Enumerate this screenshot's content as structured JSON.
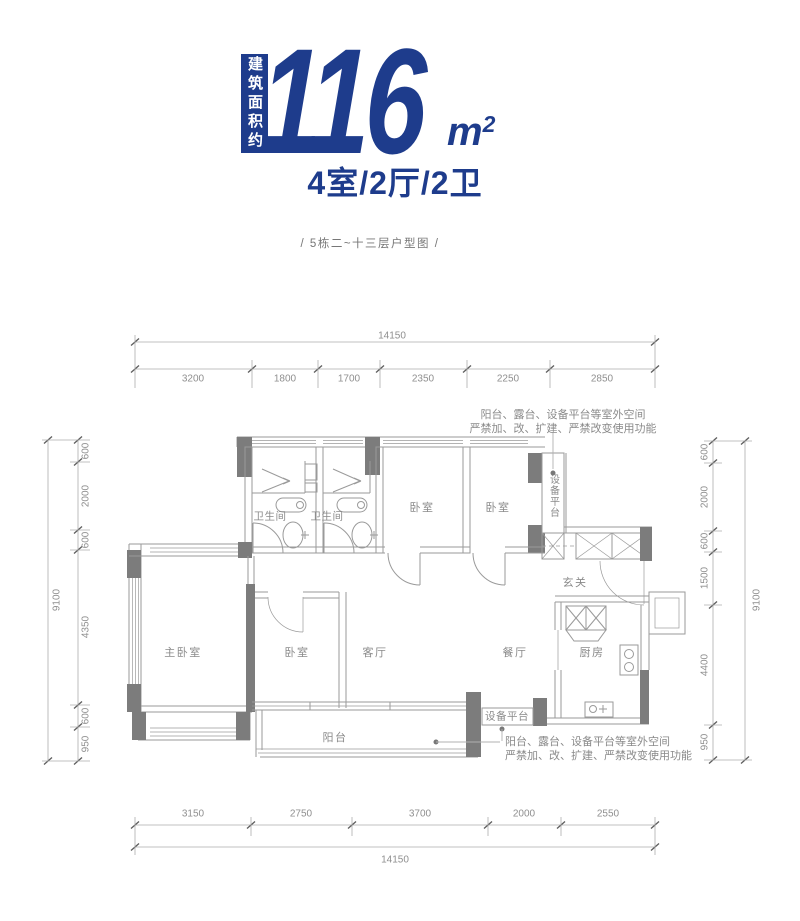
{
  "header": {
    "area_label": "建筑面积约",
    "area_value": "116",
    "area_unit": "m",
    "area_unit_sup": "2",
    "rooms_summary": "4室/2厅/2卫",
    "caption": "/ 5栋二~十三层户型图 /"
  },
  "colors": {
    "primary_blue": "#1e3c8c",
    "wall_dark": "#7c7c7c",
    "plan_line": "#9a9a9a",
    "label_gray": "#8a8a8a"
  },
  "rooms": {
    "bathroom_1": "卫生间",
    "bathroom_2": "卫生间",
    "bedroom_top_1": "卧室",
    "bedroom_top_2": "卧室",
    "equipment_platform_top": "设备平台",
    "entry": "玄关",
    "master_bedroom": "主卧室",
    "bedroom_bottom": "卧室",
    "living_room": "客厅",
    "dining_room": "餐厅",
    "kitchen": "厨房",
    "balcony": "阳台",
    "equipment_platform_bottom": "设备平台"
  },
  "annotations": {
    "outdoor_note_top": [
      "阳台、露台、设备平台等室外空间",
      "严禁加、改、扩建、严禁改变使用功能"
    ],
    "outdoor_note_bottom": [
      "阳台、露台、设备平台等室外空间",
      "严禁加、改、扩建、严禁改变使用功能"
    ]
  },
  "dimensions": {
    "top": {
      "total": "14150",
      "segments": [
        "3200",
        "1800",
        "1700",
        "2350",
        "2250",
        "2850"
      ]
    },
    "bottom": {
      "total": "14150",
      "segments": [
        "3150",
        "2750",
        "3700",
        "2000",
        "2550"
      ]
    },
    "left": {
      "total": "9100",
      "segments": [
        "600",
        "2000",
        "600",
        "4350",
        "600",
        "950"
      ]
    },
    "right": {
      "total": "9100",
      "segments": [
        "600",
        "2000",
        "600",
        "1500",
        "4400",
        "950"
      ]
    }
  }
}
